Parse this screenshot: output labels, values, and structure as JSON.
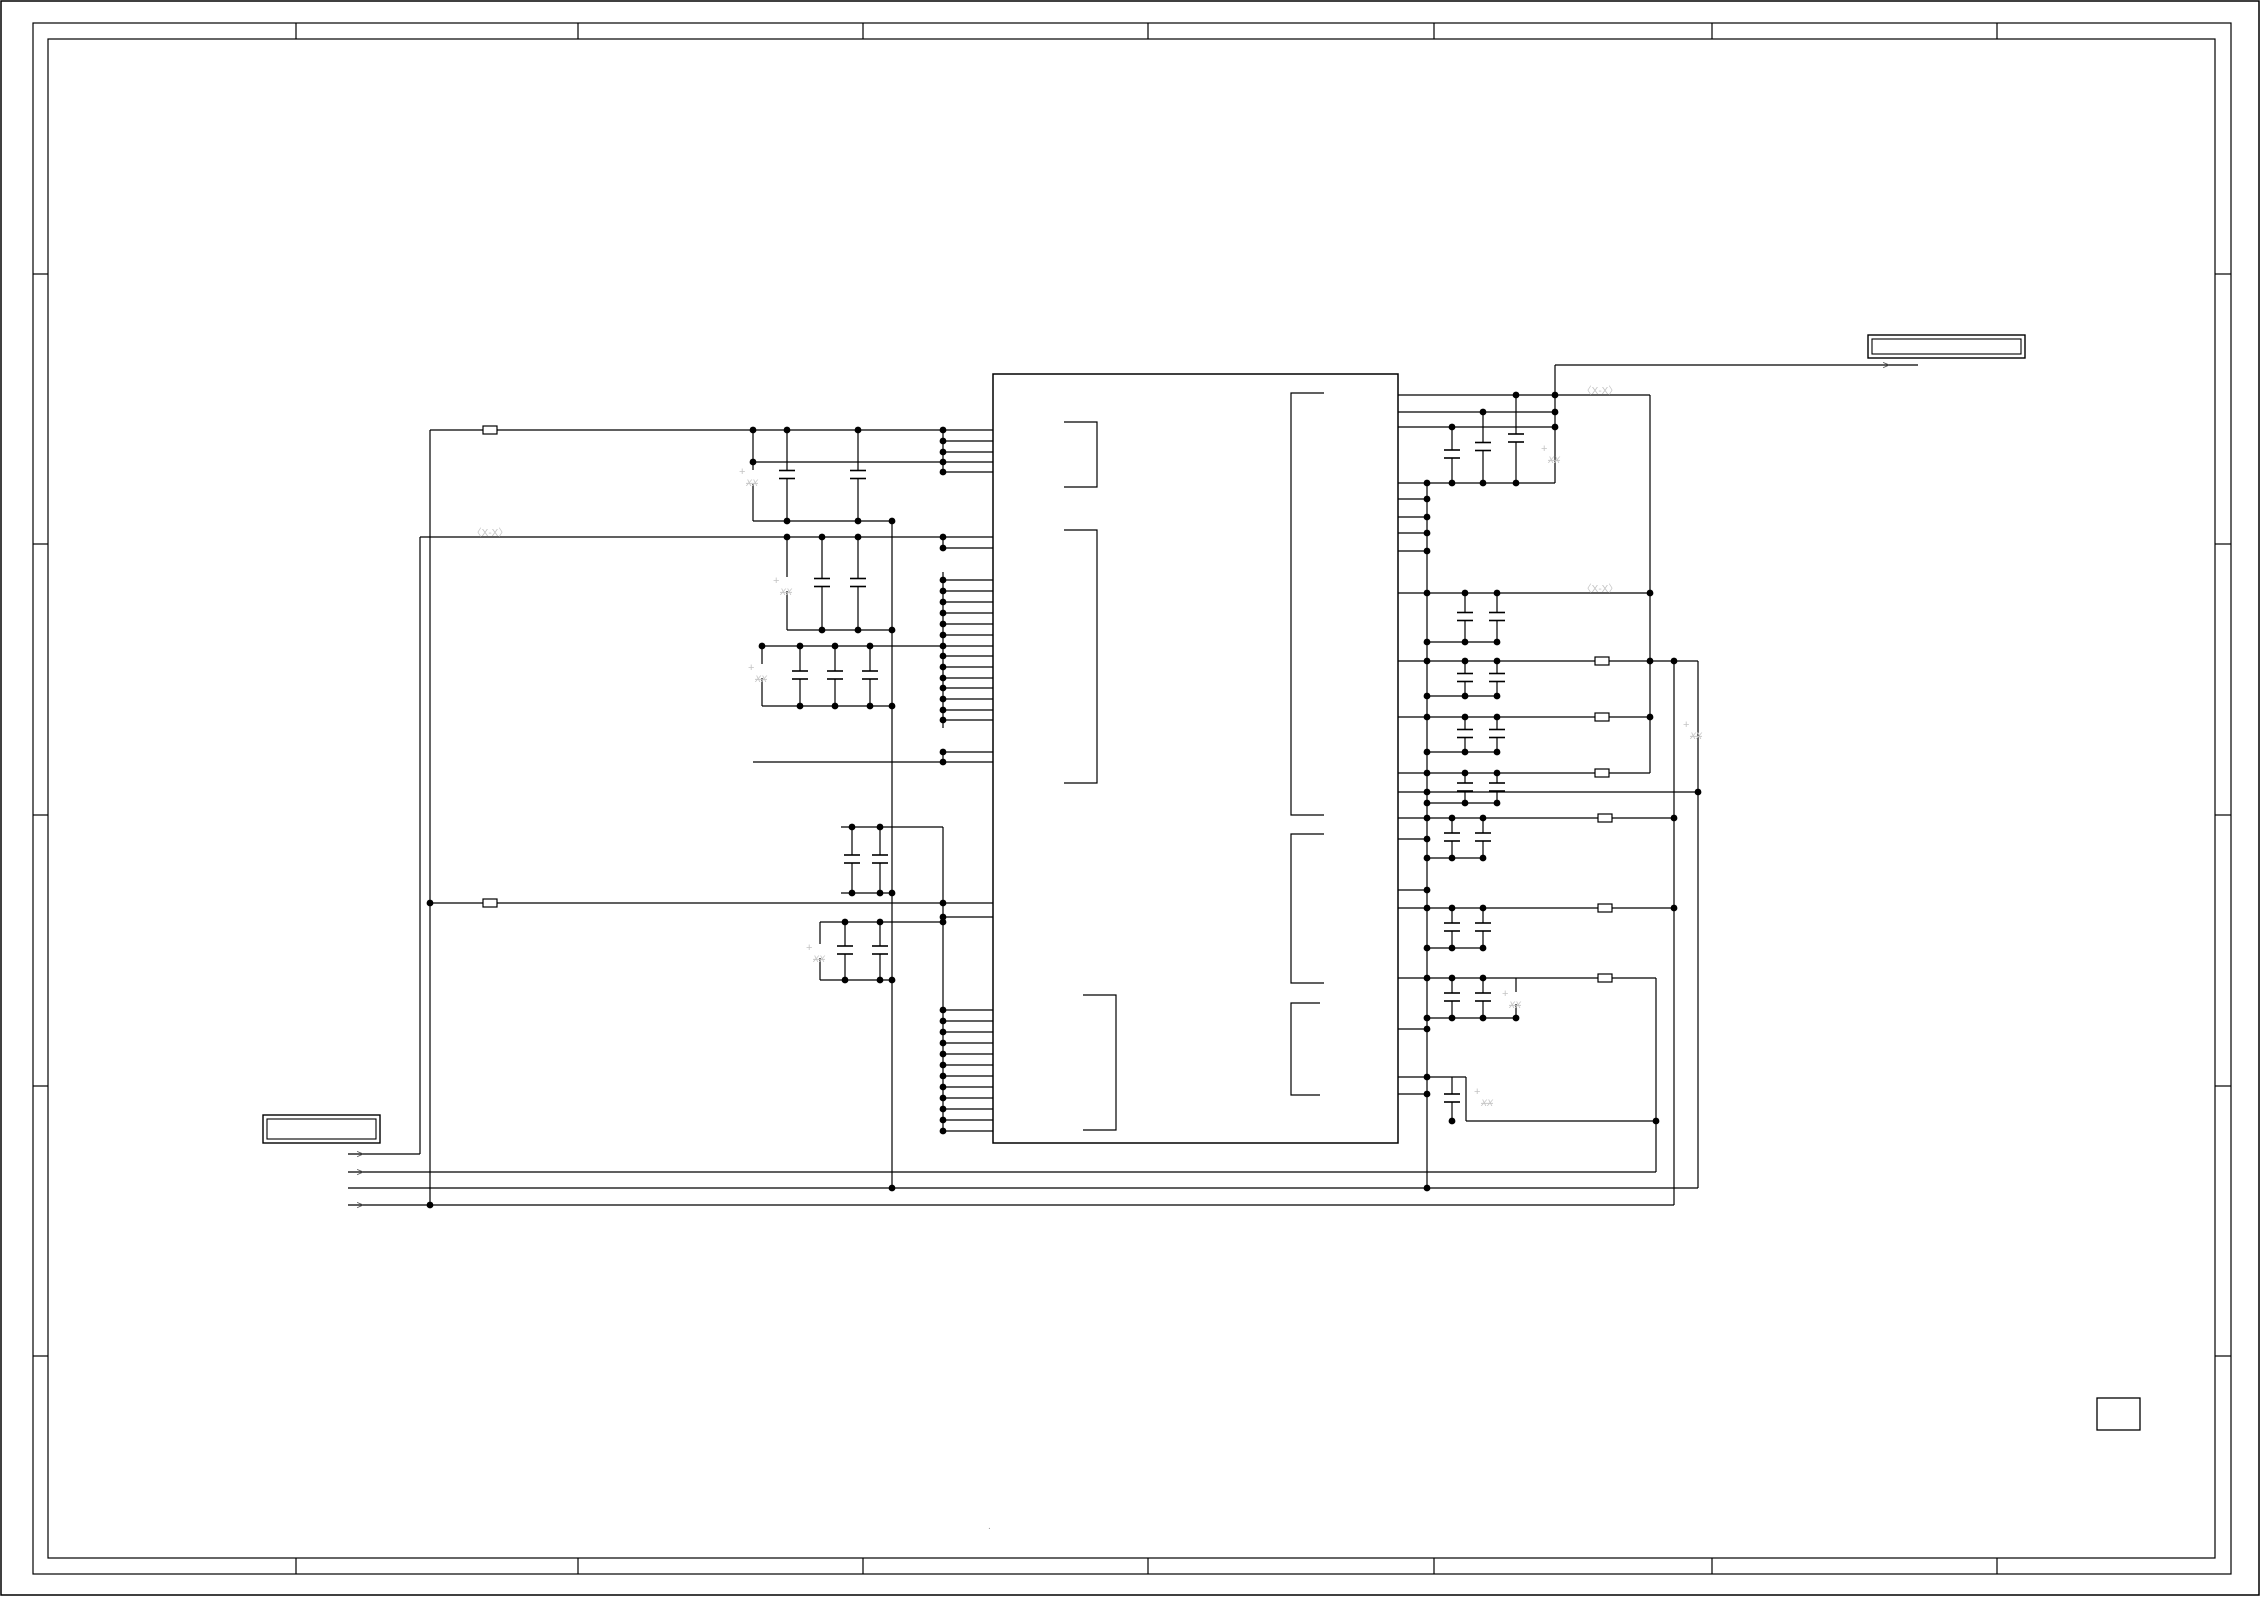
{
  "canvas": {
    "width": 2261,
    "height": 1597,
    "bg": "#ffffff",
    "wire_color": "#000000",
    "ghost_color": "#c4c4c4",
    "arrow_color": "#555555"
  },
  "frame": {
    "page_border": [
      1,
      1,
      2258,
      1594
    ],
    "outer": [
      33,
      23,
      2198,
      1551
    ],
    "inner": [
      48,
      39,
      2167,
      1519
    ],
    "ticks": [
      [
        296,
        23,
        296,
        39
      ],
      [
        578,
        23,
        578,
        39
      ],
      [
        863,
        23,
        863,
        39
      ],
      [
        1148,
        23,
        1148,
        39
      ],
      [
        1434,
        23,
        1434,
        39
      ],
      [
        1712,
        23,
        1712,
        39
      ],
      [
        1997,
        23,
        1997,
        39
      ],
      [
        296,
        1558,
        296,
        1574
      ],
      [
        578,
        1558,
        578,
        1574
      ],
      [
        863,
        1558,
        863,
        1574
      ],
      [
        1148,
        1558,
        1148,
        1574
      ],
      [
        1434,
        1558,
        1434,
        1574
      ],
      [
        1712,
        1558,
        1712,
        1574
      ],
      [
        1997,
        1558,
        1997,
        1574
      ],
      [
        33,
        274,
        48,
        274
      ],
      [
        33,
        544,
        48,
        544
      ],
      [
        33,
        815,
        48,
        815
      ],
      [
        33,
        1086,
        48,
        1086
      ],
      [
        33,
        1356,
        48,
        1356
      ],
      [
        2215,
        274,
        2231,
        274
      ],
      [
        2215,
        544,
        2231,
        544
      ],
      [
        2215,
        815,
        2231,
        815
      ],
      [
        2215,
        1086,
        2231,
        1086
      ],
      [
        2215,
        1356,
        2231,
        1356
      ]
    ]
  },
  "ic": {
    "body": [
      993,
      374,
      405,
      769
    ],
    "brackets": [
      [
        [
          1064,
          422
        ],
        [
          1097,
          422
        ],
        [
          1097,
          487
        ],
        [
          1064,
          487
        ]
      ],
      [
        [
          1064,
          530
        ],
        [
          1097,
          530
        ],
        [
          1097,
          783
        ],
        [
          1064,
          783
        ]
      ],
      [
        [
          1083,
          995
        ],
        [
          1116,
          995
        ],
        [
          1116,
          1130
        ],
        [
          1083,
          1130
        ]
      ],
      [
        [
          1324,
          393
        ],
        [
          1291,
          393
        ],
        [
          1291,
          815
        ],
        [
          1324,
          815
        ]
      ],
      [
        [
          1324,
          834
        ],
        [
          1291,
          834
        ],
        [
          1291,
          983
        ],
        [
          1324,
          983
        ]
      ],
      [
        [
          1320,
          1003
        ],
        [
          1291,
          1003
        ],
        [
          1291,
          1095
        ],
        [
          1320,
          1095
        ]
      ]
    ]
  },
  "wires": [
    [
      943,
      441,
      993,
      441
    ],
    [
      943,
      452,
      993,
      452
    ],
    [
      943,
      472,
      993,
      472
    ],
    [
      943,
      548,
      993,
      548
    ],
    [
      943,
      580,
      993,
      580
    ],
    [
      943,
      591,
      993,
      591
    ],
    [
      943,
      602,
      993,
      602
    ],
    [
      943,
      613,
      993,
      613
    ],
    [
      943,
      624,
      993,
      624
    ],
    [
      943,
      635,
      993,
      635
    ],
    [
      943,
      656,
      993,
      656
    ],
    [
      943,
      667,
      993,
      667
    ],
    [
      943,
      678,
      993,
      678
    ],
    [
      943,
      688,
      993,
      688
    ],
    [
      943,
      699,
      993,
      699
    ],
    [
      943,
      710,
      993,
      710
    ],
    [
      943,
      720,
      993,
      720
    ],
    [
      943,
      752,
      993,
      752
    ],
    [
      943,
      917,
      993,
      917
    ],
    [
      943,
      1010,
      993,
      1010
    ],
    [
      943,
      1021,
      993,
      1021
    ],
    [
      943,
      1032,
      993,
      1032
    ],
    [
      943,
      1043,
      993,
      1043
    ],
    [
      943,
      1054,
      993,
      1054
    ],
    [
      943,
      1065,
      993,
      1065
    ],
    [
      943,
      1076,
      993,
      1076
    ],
    [
      943,
      1087,
      993,
      1087
    ],
    [
      943,
      1098,
      993,
      1098
    ],
    [
      943,
      1109,
      993,
      1109
    ],
    [
      943,
      1120,
      993,
      1120
    ],
    [
      943,
      1131,
      993,
      1131
    ],
    [
      943,
      430,
      943,
      472
    ],
    [
      943,
      537,
      943,
      548
    ],
    [
      943,
      572,
      943,
      728
    ],
    [
      943,
      752,
      943,
      762
    ],
    [
      943,
      827,
      943,
      1131
    ],
    [
      430,
      430,
      993,
      430
    ],
    [
      753,
      462,
      993,
      462
    ],
    [
      420,
      537,
      993,
      537
    ],
    [
      760,
      646,
      993,
      646
    ],
    [
      753,
      762,
      993,
      762
    ],
    [
      430,
      903,
      993,
      903
    ],
    [
      841,
      827,
      943,
      827
    ],
    [
      820,
      922,
      943,
      922
    ],
    [
      420,
      537,
      420,
      1154
    ],
    [
      430,
      430,
      430,
      1205
    ],
    [
      892,
      521,
      892,
      1188
    ],
    [
      753,
      430,
      753,
      470
    ],
    [
      753,
      484,
      753,
      521
    ],
    [
      787,
      537,
      787,
      577
    ],
    [
      787,
      591,
      787,
      630
    ],
    [
      762,
      646,
      762,
      664
    ],
    [
      762,
      678,
      762,
      706
    ],
    [
      820,
      922,
      820,
      944
    ],
    [
      820,
      958,
      820,
      980
    ],
    [
      753,
      521,
      892,
      521
    ],
    [
      787,
      630,
      892,
      630
    ],
    [
      762,
      706,
      892,
      706
    ],
    [
      841,
      893,
      892,
      893
    ],
    [
      820,
      980,
      892,
      980
    ],
    [
      348,
      1154,
      420,
      1154
    ],
    [
      348,
      1172,
      1656,
      1172
    ],
    [
      348,
      1188,
      1698,
      1188
    ],
    [
      348,
      1205,
      1674,
      1205
    ],
    [
      1398,
      483,
      1427,
      483
    ],
    [
      1398,
      499,
      1427,
      499
    ],
    [
      1398,
      517,
      1427,
      517
    ],
    [
      1398,
      533,
      1427,
      533
    ],
    [
      1398,
      551,
      1427,
      551
    ],
    [
      1398,
      593,
      1427,
      593
    ],
    [
      1398,
      661,
      1427,
      661
    ],
    [
      1398,
      717,
      1427,
      717
    ],
    [
      1398,
      773,
      1427,
      773
    ],
    [
      1398,
      792,
      1427,
      792
    ],
    [
      1398,
      818,
      1427,
      818
    ],
    [
      1398,
      839,
      1427,
      839
    ],
    [
      1398,
      890,
      1427,
      890
    ],
    [
      1398,
      908,
      1427,
      908
    ],
    [
      1398,
      978,
      1427,
      978
    ],
    [
      1398,
      1029,
      1427,
      1029
    ],
    [
      1398,
      1094,
      1427,
      1094
    ],
    [
      1427,
      483,
      1427,
      1188
    ],
    [
      1398,
      395,
      1650,
      395
    ],
    [
      1398,
      412,
      1555,
      412
    ],
    [
      1398,
      427,
      1555,
      427
    ],
    [
      1427,
      483,
      1555,
      483
    ],
    [
      1555,
      365,
      1555,
      483
    ],
    [
      1555,
      365,
      1918,
      365
    ],
    [
      1427,
      593,
      1650,
      593
    ],
    [
      1427,
      642,
      1497,
      642
    ],
    [
      1427,
      661,
      1698,
      661
    ],
    [
      1427,
      696,
      1497,
      696
    ],
    [
      1427,
      717,
      1650,
      717
    ],
    [
      1427,
      752,
      1497,
      752
    ],
    [
      1427,
      773,
      1650,
      773
    ],
    [
      1427,
      803,
      1497,
      803
    ],
    [
      1427,
      792,
      1698,
      792
    ],
    [
      1427,
      818,
      1674,
      818
    ],
    [
      1427,
      858,
      1483,
      858
    ],
    [
      1427,
      908,
      1674,
      908
    ],
    [
      1427,
      948,
      1483,
      948
    ],
    [
      1427,
      978,
      1656,
      978
    ],
    [
      1427,
      1018,
      1516,
      1018
    ],
    [
      1516,
      978,
      1516,
      992
    ],
    [
      1516,
      1004,
      1516,
      1018
    ],
    [
      1398,
      1077,
      1466,
      1077
    ],
    [
      1466,
      1077,
      1466,
      1121
    ],
    [
      1466,
      1121,
      1656,
      1121
    ],
    [
      1650,
      395,
      1650,
      773
    ],
    [
      1674,
      661,
      1674,
      1205
    ],
    [
      1698,
      661,
      1698,
      1188
    ],
    [
      1656,
      978,
      1656,
      1172
    ]
  ],
  "caps": [
    [
      787,
      430,
      521
    ],
    [
      858,
      430,
      521
    ],
    [
      822,
      537,
      630
    ],
    [
      858,
      537,
      630
    ],
    [
      800,
      646,
      706
    ],
    [
      835,
      646,
      706
    ],
    [
      870,
      646,
      706
    ],
    [
      852,
      827,
      893
    ],
    [
      880,
      827,
      893
    ],
    [
      845,
      922,
      980
    ],
    [
      880,
      922,
      980
    ],
    [
      1452,
      427,
      483
    ],
    [
      1483,
      412,
      483
    ],
    [
      1516,
      395,
      483
    ],
    [
      1465,
      593,
      642
    ],
    [
      1497,
      593,
      642
    ],
    [
      1465,
      661,
      696
    ],
    [
      1497,
      661,
      696
    ],
    [
      1465,
      717,
      752
    ],
    [
      1497,
      717,
      752
    ],
    [
      1465,
      773,
      803
    ],
    [
      1497,
      773,
      803
    ],
    [
      1452,
      818,
      858
    ],
    [
      1483,
      818,
      858
    ],
    [
      1452,
      908,
      948
    ],
    [
      1483,
      908,
      948
    ],
    [
      1452,
      978,
      1018
    ],
    [
      1483,
      978,
      1018
    ],
    [
      1452,
      1077,
      1121
    ]
  ],
  "beads": [
    [
      490,
      430
    ],
    [
      490,
      903
    ],
    [
      1602,
      661
    ],
    [
      1602,
      717
    ],
    [
      1602,
      773
    ],
    [
      1605,
      818
    ],
    [
      1605,
      908
    ],
    [
      1605,
      978
    ]
  ],
  "dots": [
    [
      943,
      430
    ],
    [
      943,
      441
    ],
    [
      943,
      452
    ],
    [
      943,
      462
    ],
    [
      943,
      472
    ],
    [
      943,
      537
    ],
    [
      943,
      548
    ],
    [
      943,
      580
    ],
    [
      943,
      591
    ],
    [
      943,
      602
    ],
    [
      943,
      613
    ],
    [
      943,
      624
    ],
    [
      943,
      635
    ],
    [
      943,
      646
    ],
    [
      943,
      656
    ],
    [
      943,
      667
    ],
    [
      943,
      678
    ],
    [
      943,
      688
    ],
    [
      943,
      699
    ],
    [
      943,
      710
    ],
    [
      943,
      720
    ],
    [
      943,
      752
    ],
    [
      943,
      762
    ],
    [
      943,
      903
    ],
    [
      943,
      917
    ],
    [
      943,
      922
    ],
    [
      943,
      1010
    ],
    [
      943,
      1021
    ],
    [
      943,
      1032
    ],
    [
      943,
      1043
    ],
    [
      943,
      1054
    ],
    [
      943,
      1065
    ],
    [
      943,
      1076
    ],
    [
      943,
      1087
    ],
    [
      943,
      1098
    ],
    [
      943,
      1109
    ],
    [
      943,
      1120
    ],
    [
      943,
      1131
    ],
    [
      753,
      430
    ],
    [
      787,
      430
    ],
    [
      858,
      430
    ],
    [
      753,
      462
    ],
    [
      787,
      521
    ],
    [
      858,
      521
    ],
    [
      892,
      521
    ],
    [
      787,
      537
    ],
    [
      822,
      537
    ],
    [
      858,
      537
    ],
    [
      822,
      630
    ],
    [
      858,
      630
    ],
    [
      892,
      630
    ],
    [
      762,
      646
    ],
    [
      800,
      646
    ],
    [
      835,
      646
    ],
    [
      870,
      646
    ],
    [
      800,
      706
    ],
    [
      835,
      706
    ],
    [
      870,
      706
    ],
    [
      892,
      706
    ],
    [
      852,
      827
    ],
    [
      880,
      827
    ],
    [
      852,
      893
    ],
    [
      880,
      893
    ],
    [
      892,
      893
    ],
    [
      430,
      903
    ],
    [
      845,
      922
    ],
    [
      880,
      922
    ],
    [
      845,
      980
    ],
    [
      880,
      980
    ],
    [
      892,
      980
    ],
    [
      430,
      1205
    ],
    [
      892,
      1188
    ],
    [
      1427,
      1188
    ],
    [
      1427,
      483
    ],
    [
      1427,
      499
    ],
    [
      1427,
      517
    ],
    [
      1427,
      533
    ],
    [
      1427,
      551
    ],
    [
      1427,
      593
    ],
    [
      1427,
      642
    ],
    [
      1427,
      661
    ],
    [
      1427,
      696
    ],
    [
      1427,
      717
    ],
    [
      1427,
      752
    ],
    [
      1427,
      773
    ],
    [
      1427,
      792
    ],
    [
      1427,
      803
    ],
    [
      1427,
      818
    ],
    [
      1427,
      839
    ],
    [
      1427,
      858
    ],
    [
      1427,
      890
    ],
    [
      1427,
      908
    ],
    [
      1427,
      948
    ],
    [
      1427,
      978
    ],
    [
      1427,
      1018
    ],
    [
      1427,
      1029
    ],
    [
      1427,
      1077
    ],
    [
      1427,
      1094
    ],
    [
      1452,
      427
    ],
    [
      1483,
      412
    ],
    [
      1516,
      395
    ],
    [
      1555,
      395
    ],
    [
      1555,
      412
    ],
    [
      1555,
      427
    ],
    [
      1452,
      483
    ],
    [
      1483,
      483
    ],
    [
      1516,
      483
    ],
    [
      1465,
      593
    ],
    [
      1497,
      593
    ],
    [
      1650,
      593
    ],
    [
      1465,
      642
    ],
    [
      1497,
      642
    ],
    [
      1465,
      661
    ],
    [
      1497,
      661
    ],
    [
      1650,
      661
    ],
    [
      1674,
      661
    ],
    [
      1465,
      696
    ],
    [
      1497,
      696
    ],
    [
      1465,
      717
    ],
    [
      1497,
      717
    ],
    [
      1650,
      717
    ],
    [
      1465,
      752
    ],
    [
      1497,
      752
    ],
    [
      1465,
      773
    ],
    [
      1497,
      773
    ],
    [
      1465,
      803
    ],
    [
      1497,
      803
    ],
    [
      1698,
      792
    ],
    [
      1452,
      818
    ],
    [
      1483,
      818
    ],
    [
      1674,
      818
    ],
    [
      1452,
      858
    ],
    [
      1483,
      858
    ],
    [
      1452,
      908
    ],
    [
      1483,
      908
    ],
    [
      1674,
      908
    ],
    [
      1452,
      948
    ],
    [
      1483,
      948
    ],
    [
      1452,
      978
    ],
    [
      1483,
      978
    ],
    [
      1452,
      1018
    ],
    [
      1483,
      1018
    ],
    [
      1516,
      1018
    ],
    [
      1656,
      1121
    ],
    [
      1452,
      1121
    ]
  ],
  "ghost_caps": {
    "plus_glyph": "+",
    "value_glyph": "XX",
    "positions": [
      [
        745,
        475
      ],
      [
        779,
        584
      ],
      [
        754,
        671
      ],
      [
        812,
        951
      ],
      [
        1547,
        452
      ],
      [
        1689,
        728
      ],
      [
        1508,
        997
      ],
      [
        1480,
        1095
      ]
    ]
  },
  "net_labels": {
    "glyph": "〈X-X〉",
    "positions": [
      [
        490,
        533
      ],
      [
        1600,
        391
      ],
      [
        1600,
        589
      ]
    ]
  },
  "arrows": {
    "glyph": ">",
    "positions": [
      [
        360,
        1154
      ],
      [
        360,
        1172
      ],
      [
        360,
        1205
      ],
      [
        1886,
        365
      ]
    ]
  },
  "connector_boxes": {
    "left": {
      "outer": [
        263,
        1115,
        117,
        28
      ],
      "inner": [
        267,
        1119,
        109,
        20
      ]
    },
    "right": {
      "outer": [
        1868,
        335,
        157,
        23
      ],
      "inner": [
        1872,
        339,
        149,
        15
      ]
    }
  },
  "misc_box": [
    2097,
    1398,
    43,
    32
  ],
  "speck": {
    "glyph": ".",
    "x": 988,
    "y": 1529
  }
}
